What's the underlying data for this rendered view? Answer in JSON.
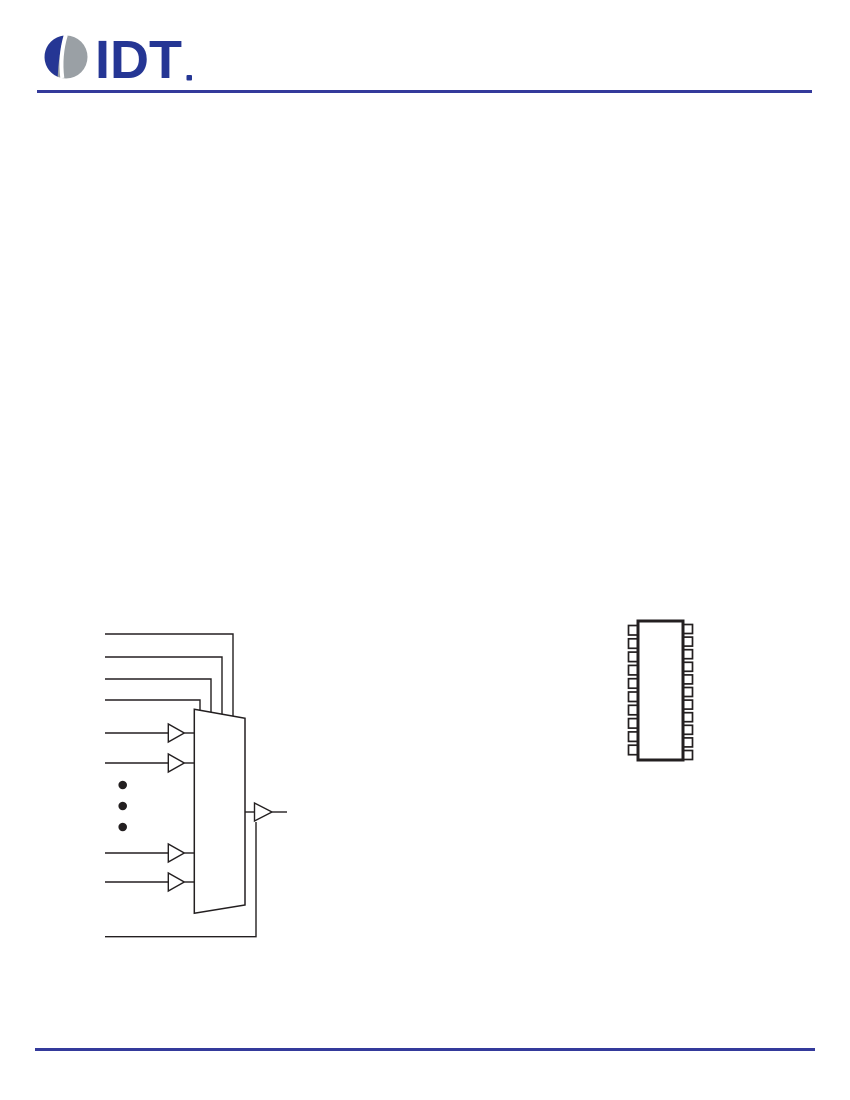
{
  "page": {
    "width": 850,
    "height": 1100,
    "background": "#ffffff"
  },
  "header": {
    "logo": {
      "text": "IDT",
      "mark": "®",
      "brand_blue": "#253694",
      "brand_gray": "#9aa0a5"
    },
    "rule_color": "#343a9b"
  },
  "figures": {
    "mux_diagram": {
      "icon": "multiplexer-symbol",
      "select_lines": 4,
      "buffered_inputs": 4,
      "ellipsis_dots": 3,
      "output_buffers": 1,
      "line_color": "#231f20"
    },
    "package_diagram": {
      "icon": "ic-package-outline",
      "left_pins": 10,
      "right_pins": 11,
      "line_color": "#231f20"
    }
  },
  "footer": {
    "rule_color": "#343a9b"
  }
}
